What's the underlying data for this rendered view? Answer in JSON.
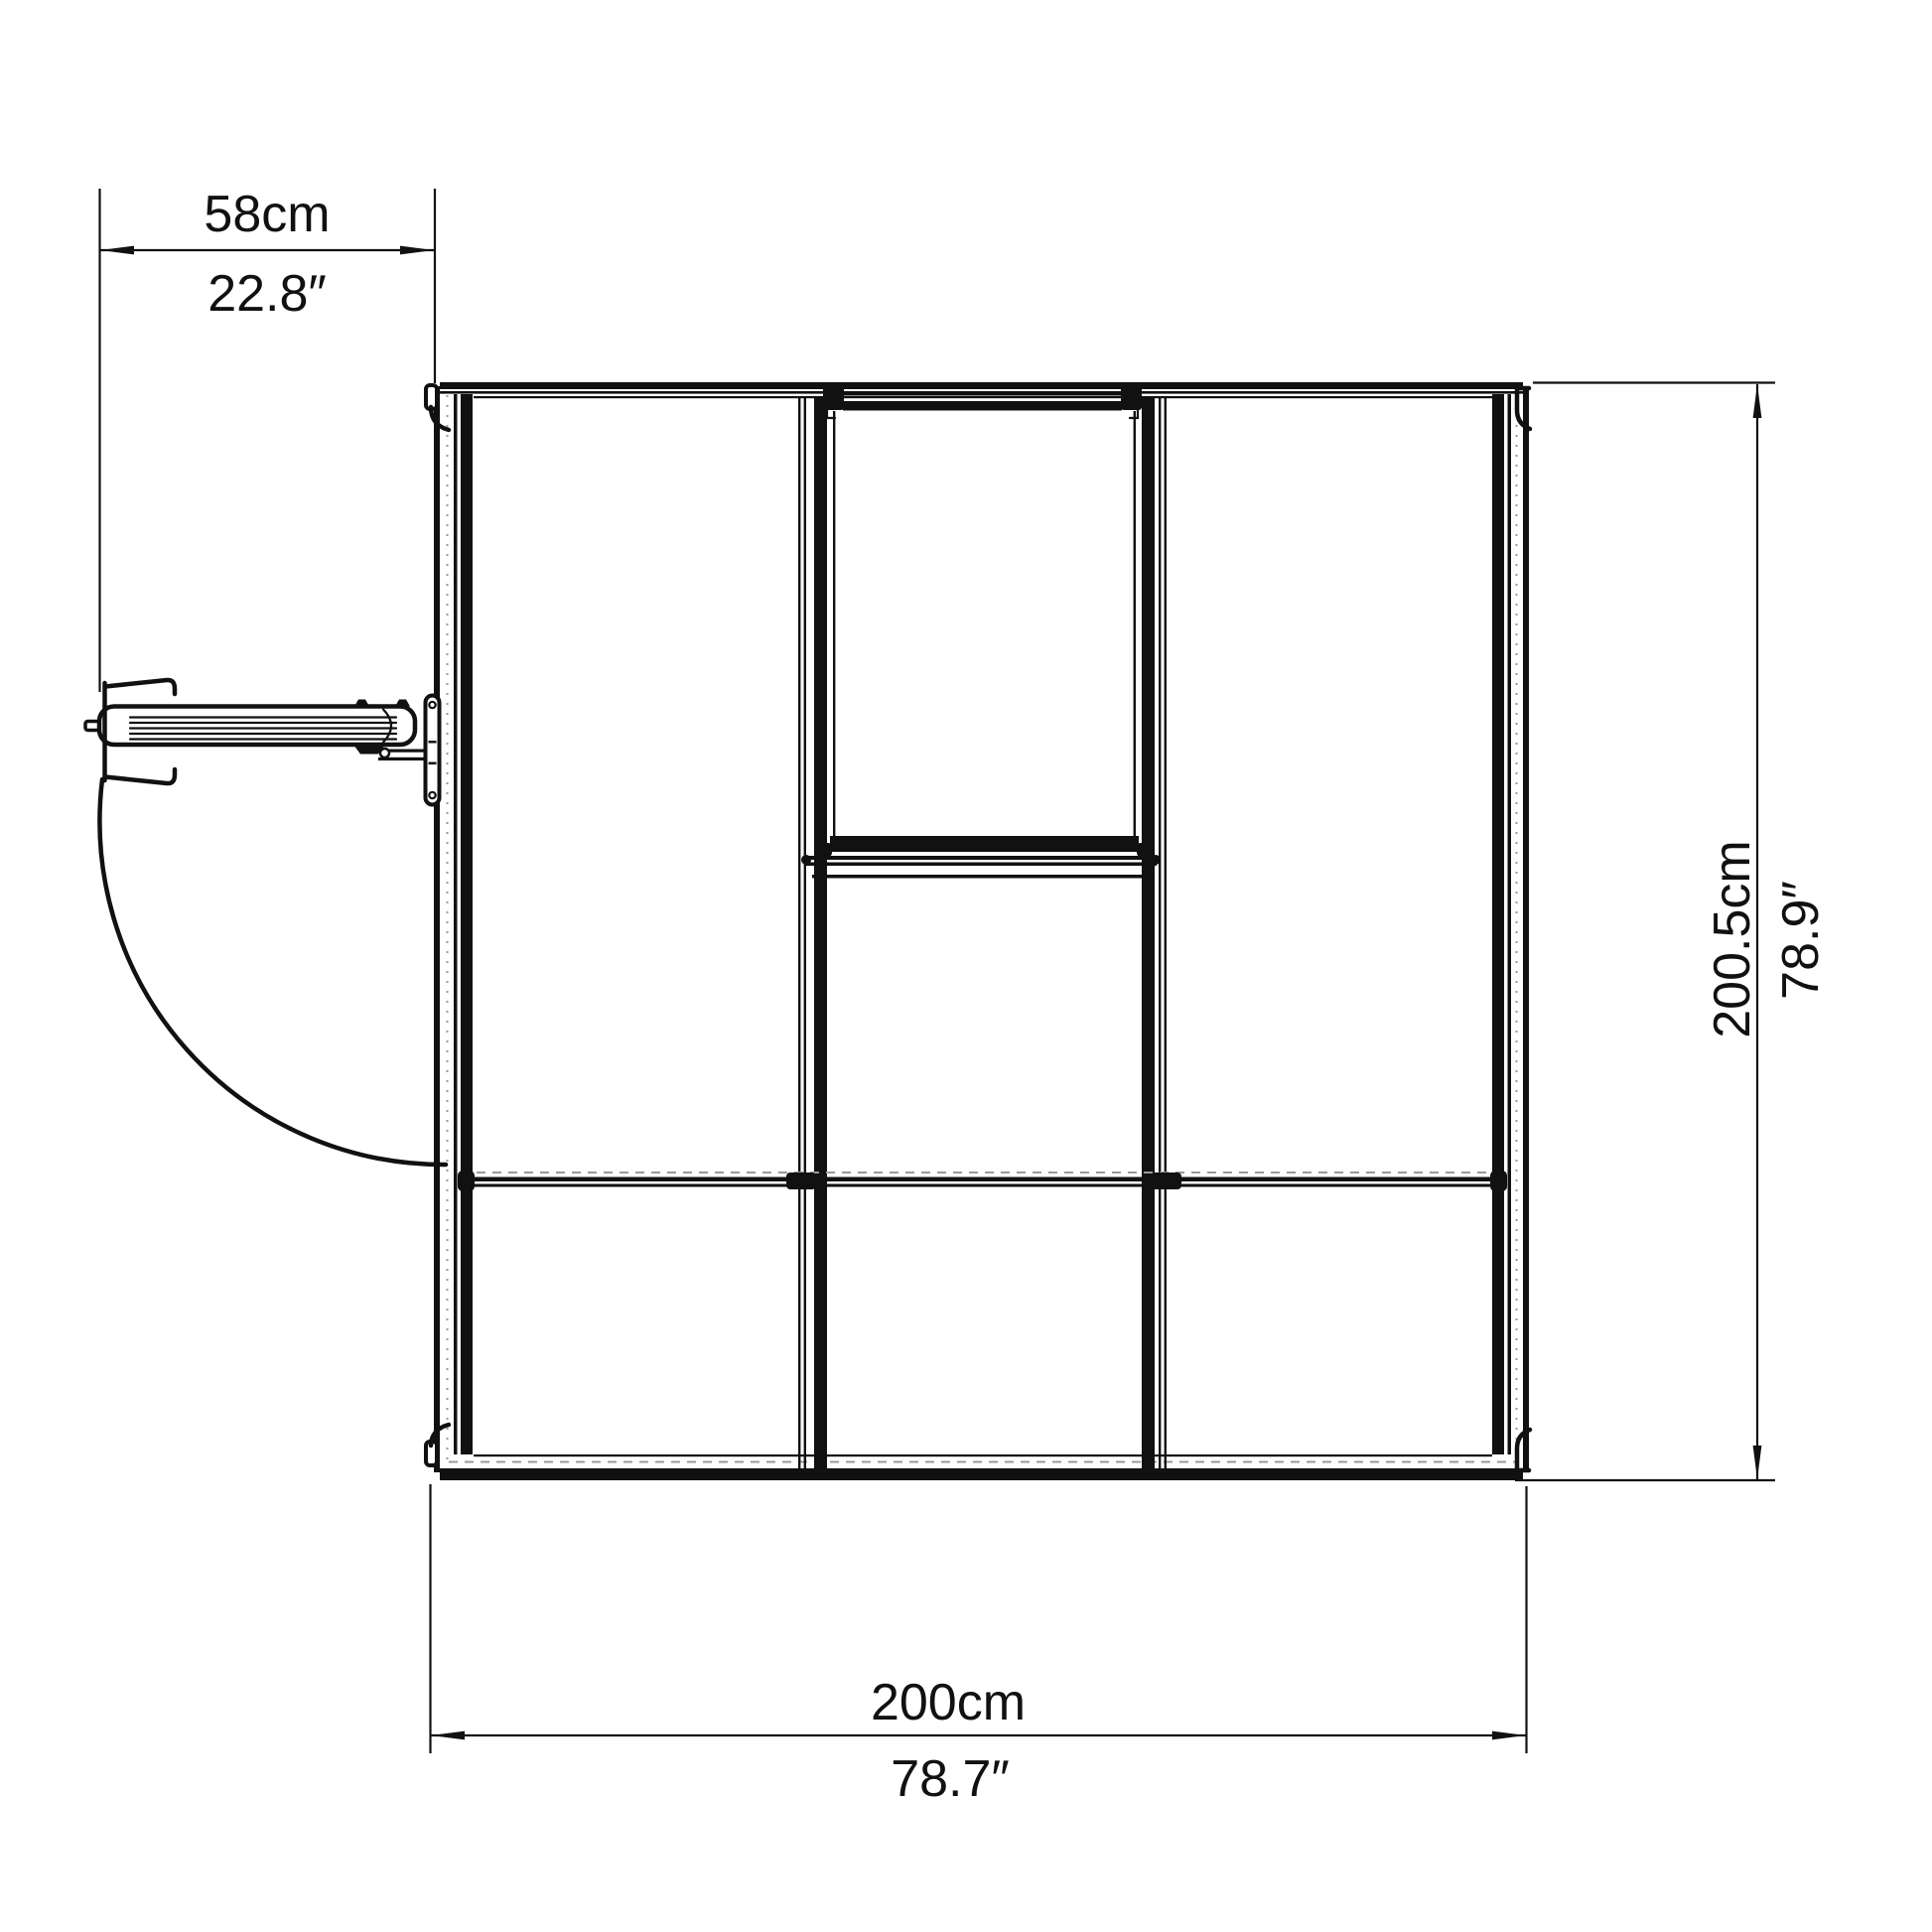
{
  "drawing": {
    "title": "Greenhouse plan (top) view",
    "colors": {
      "line": "#111111",
      "hidden": "#9a9a9a",
      "bg": "#ffffff"
    },
    "dims": {
      "door": {
        "metric": "58cm",
        "imperial": "22.8″"
      },
      "width": {
        "metric": "200cm",
        "imperial": "78.7″"
      },
      "depth": {
        "metric": "200.5cm",
        "imperial": "78.9″"
      }
    }
  }
}
